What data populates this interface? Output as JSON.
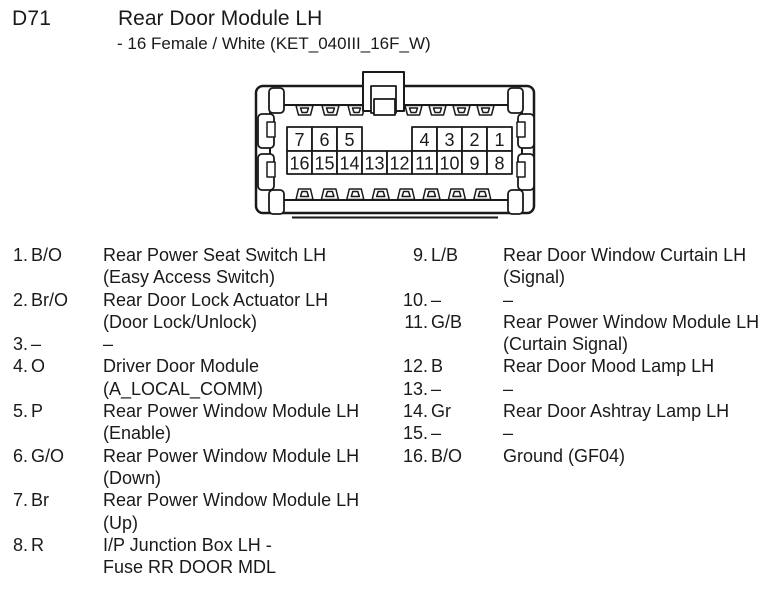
{
  "header": {
    "connector_id": "D71",
    "title": "Rear Door Module LH",
    "subtitle": "- 16 Female / White (KET_040III_16F_W)"
  },
  "connector": {
    "description": "16-pin female connector front view",
    "top_row": [
      "7",
      "6",
      "5",
      null,
      null,
      "4",
      "3",
      "2",
      "1"
    ],
    "bottom_row": [
      "16",
      "15",
      "14",
      "13",
      "12",
      "11",
      "10",
      "9",
      "8"
    ]
  },
  "pins": {
    "left": [
      {
        "num": "1.",
        "color": "B/O",
        "lines": [
          "Rear Power Seat Switch LH",
          "(Easy Access Switch)"
        ]
      },
      {
        "num": "2.",
        "color": "Br/O",
        "lines": [
          "Rear Door Lock Actuator LH",
          "(Door Lock/Unlock)"
        ]
      },
      {
        "num": "3.",
        "color": "–",
        "lines": [
          "–"
        ]
      },
      {
        "num": "4.",
        "color": "O",
        "lines": [
          "Driver Door Module",
          "(A_LOCAL_COMM)"
        ]
      },
      {
        "num": "5.",
        "color": "P",
        "lines": [
          "Rear Power Window Module LH",
          "(Enable)"
        ]
      },
      {
        "num": "6.",
        "color": "G/O",
        "lines": [
          "Rear Power Window Module LH",
          "(Down)"
        ]
      },
      {
        "num": "7.",
        "color": "Br",
        "lines": [
          "Rear Power Window Module LH",
          "(Up)"
        ]
      },
      {
        "num": "8.",
        "color": "R",
        "lines": [
          "I/P Junction Box LH -",
          "Fuse RR DOOR MDL"
        ]
      }
    ],
    "right": [
      {
        "num": "9.",
        "color": "L/B",
        "lines": [
          "Rear Door Window Curtain LH",
          "(Signal)"
        ]
      },
      {
        "num": "10.",
        "color": "–",
        "lines": [
          "–"
        ]
      },
      {
        "num": "11.",
        "color": "G/B",
        "lines": [
          "Rear Power Window Module LH",
          "(Curtain Signal)"
        ]
      },
      {
        "num": "12.",
        "color": "B",
        "lines": [
          "Rear Door Mood Lamp LH"
        ]
      },
      {
        "num": "13.",
        "color": "–",
        "lines": [
          "–"
        ]
      },
      {
        "num": "14.",
        "color": "Gr",
        "lines": [
          "Rear Door Ashtray Lamp LH"
        ]
      },
      {
        "num": "15.",
        "color": "–",
        "lines": [
          "–"
        ]
      },
      {
        "num": "16.",
        "color": "B/O",
        "lines": [
          "Ground (GF04)"
        ]
      }
    ]
  },
  "colors": {
    "ink": "#1a1a1a",
    "line": "#1a1a1a",
    "background": "#ffffff"
  }
}
